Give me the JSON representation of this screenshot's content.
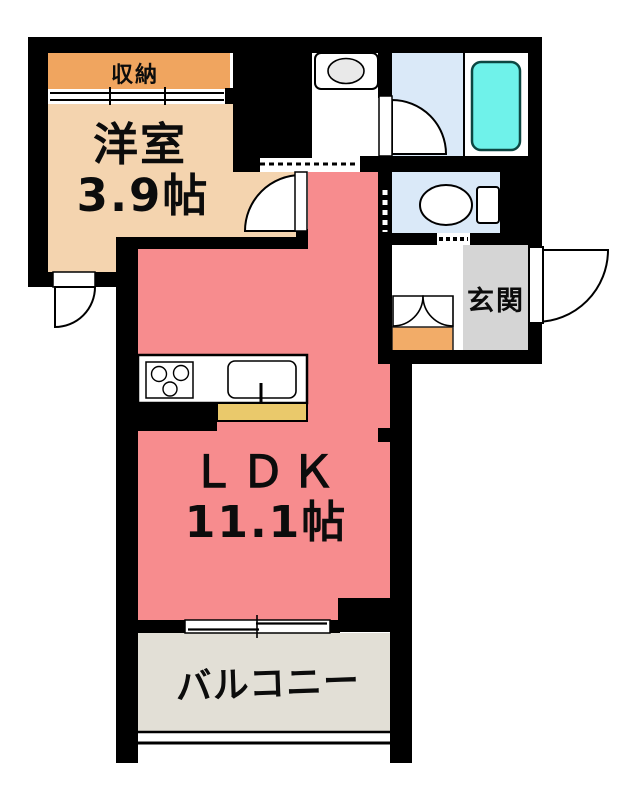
{
  "labels": {
    "closet": "収納",
    "western_room_name": "洋室",
    "western_room_size": "3.9帖",
    "ldk_name": "ＬＤＫ",
    "ldk_size": "11.1帖",
    "entrance": "玄関",
    "balcony": "バルコニー"
  },
  "colors": {
    "wall": "#000000",
    "closet": "#F0A55F",
    "western_room": "#F4D4AF",
    "ldk": "#F78C8E",
    "wet_area": "#DAE9F8",
    "bathtub": "#6FF2EA",
    "bathtub_outline": "#0C4742",
    "entrance": "#D5D5D5",
    "shoe_cabinet": "#F2AC68",
    "balcony": "#E2DFD6",
    "kitchen_counter_front": "#EAC96B",
    "washer_drum": "#E9E9E9"
  }
}
